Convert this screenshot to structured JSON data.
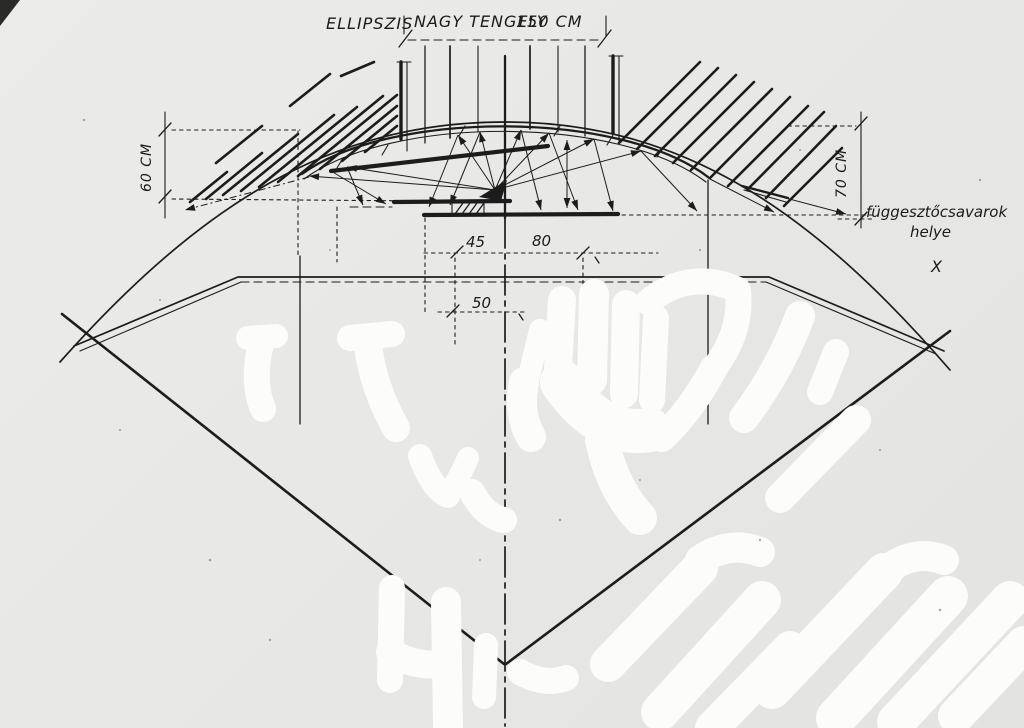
{
  "palette": {
    "paper": "#e8e8e6",
    "ink": "#1c1c1c",
    "whiteout": "#fcfcfb"
  },
  "labels": {
    "ellipszis": "ELLIPSZIS",
    "nagy_tengely": "NAGY TENGELY",
    "axis_value": "150 CM",
    "dim_left": "60 CM",
    "dim_right": "70 CM",
    "dim_45": "45",
    "dim_80": "80",
    "dim_50": "50",
    "note_line1": "függesztőcsavarok",
    "note_line2": "helye",
    "note_mark": "X"
  }
}
